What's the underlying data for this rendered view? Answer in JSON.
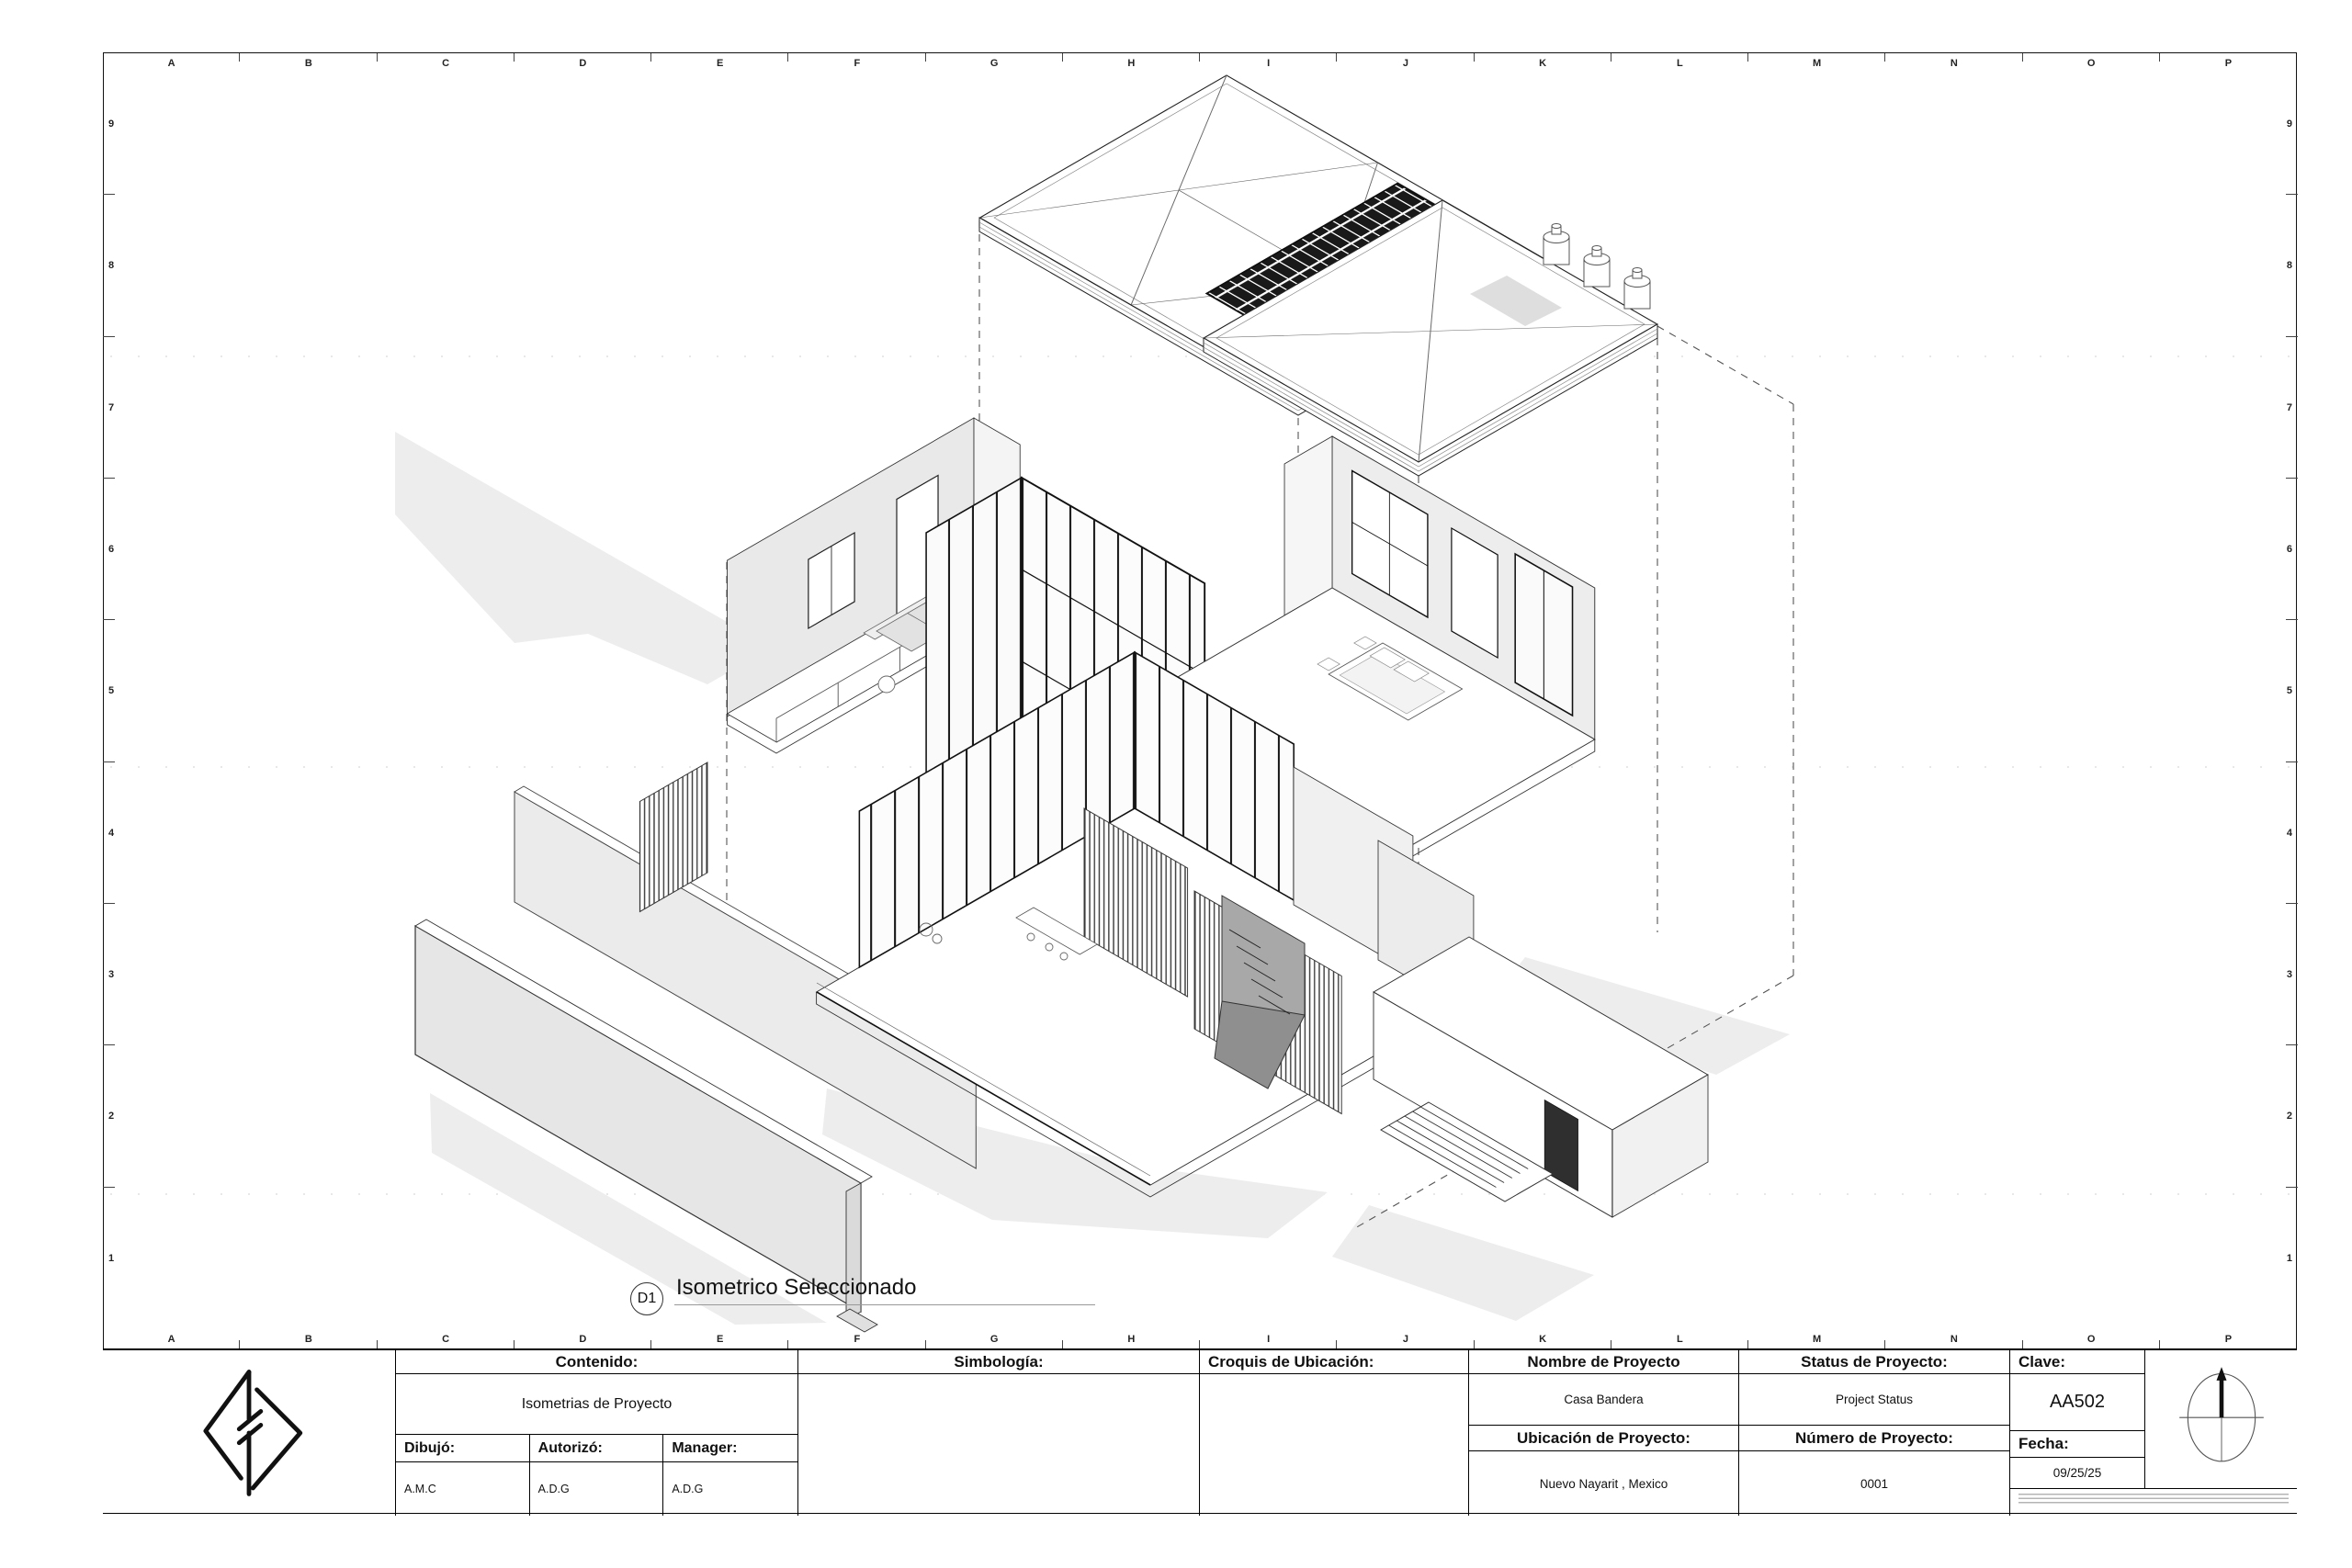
{
  "sheet": {
    "grid_letters": [
      "A",
      "B",
      "C",
      "D",
      "E",
      "F",
      "G",
      "H",
      "I",
      "J",
      "K",
      "L",
      "M",
      "N",
      "O",
      "P"
    ],
    "grid_numbers": [
      "9",
      "8",
      "7",
      "6",
      "5",
      "4",
      "3",
      "2",
      "1"
    ],
    "paper_color": "#ffffff",
    "line_color": "#1a1a1a"
  },
  "drawing": {
    "view_tag": "D1",
    "view_title": "Isometrico Seleccionado",
    "description": "exploded-isometric-house-drawing"
  },
  "title_block": {
    "contenido": {
      "label": "Contenido:",
      "value": "Isometrias de Proyecto"
    },
    "dibujo": {
      "label": "Dibujó:",
      "value": "A.M.C"
    },
    "autorizo": {
      "label": "Autorizó:",
      "value": "A.D.G"
    },
    "manager": {
      "label": "Manager:",
      "value": "A.D.G"
    },
    "simbologia": {
      "label": "Simbología:"
    },
    "croquis": {
      "label": "Croquis de Ubicación:"
    },
    "nombre": {
      "label": "Nombre de Proyecto",
      "value": "Casa Bandera"
    },
    "ubicacion": {
      "label": "Ubicación de Proyecto:",
      "value": "Nuevo Nayarit , Mexico"
    },
    "status": {
      "label": "Status de Proyecto:",
      "value": "Project Status"
    },
    "numero": {
      "label": "Número de Proyecto:",
      "value": "0001"
    },
    "clave": {
      "label": "Clave:",
      "value": "AA502"
    },
    "fecha": {
      "label": "Fecha:",
      "value": "09/25/25"
    }
  }
}
